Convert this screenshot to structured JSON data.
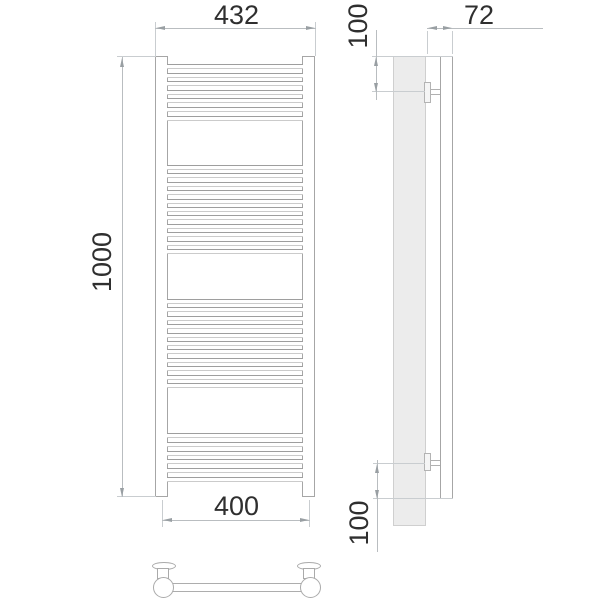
{
  "drawing": {
    "product": "ladder-towel-radiator",
    "dimensions": {
      "top_width": "432",
      "height": "1000",
      "bottom_width": "400",
      "depth": "72",
      "top_offset": "100",
      "bottom_offset": "100"
    }
  },
  "colors": {
    "outline": "#a6a6a6",
    "outline_light": "#cbcbcb",
    "dimension_line": "#b9bdc0",
    "arrow": "#999fa3",
    "text": "#2f2f2f",
    "wall_fill": "#ececec"
  },
  "front_view": {
    "tube_bands": [
      {
        "y": 64,
        "count": 7,
        "pitch": 8.6
      },
      {
        "y": 165,
        "count": 11,
        "pitch": 8.4
      },
      {
        "y": 299,
        "count": 11,
        "pitch": 8.4
      },
      {
        "y": 433,
        "count": 6,
        "pitch": 8.8
      }
    ]
  }
}
